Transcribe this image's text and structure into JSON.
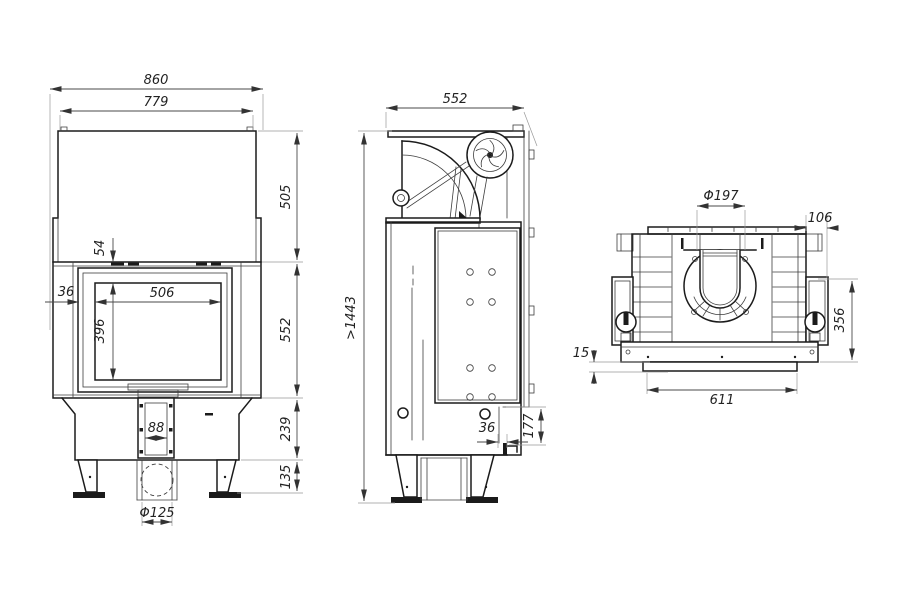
{
  "drawing": {
    "type": "fireplace-insert-technical-drawing",
    "views": {
      "front": {
        "dims": {
          "overall_width": "860",
          "body_width": "779",
          "hood_height": "505",
          "top_gap": "54",
          "frame_offset": "36",
          "glass_width": "506",
          "glass_height": "396",
          "front_height": "552",
          "duct_width": "88",
          "base_height": "239",
          "leg_height": "135",
          "intake_diameter": "Φ125"
        }
      },
      "side": {
        "dims": {
          "depth": "552",
          "min_total_height": ">1443",
          "rear_offset": "36",
          "rear_step_height": "177"
        }
      },
      "rear": {
        "dims": {
          "flue_diameter": "Φ197",
          "top_right_offset": "106",
          "base_lip_height": "15",
          "mount_height": "356",
          "base_width": "611"
        }
      }
    }
  }
}
